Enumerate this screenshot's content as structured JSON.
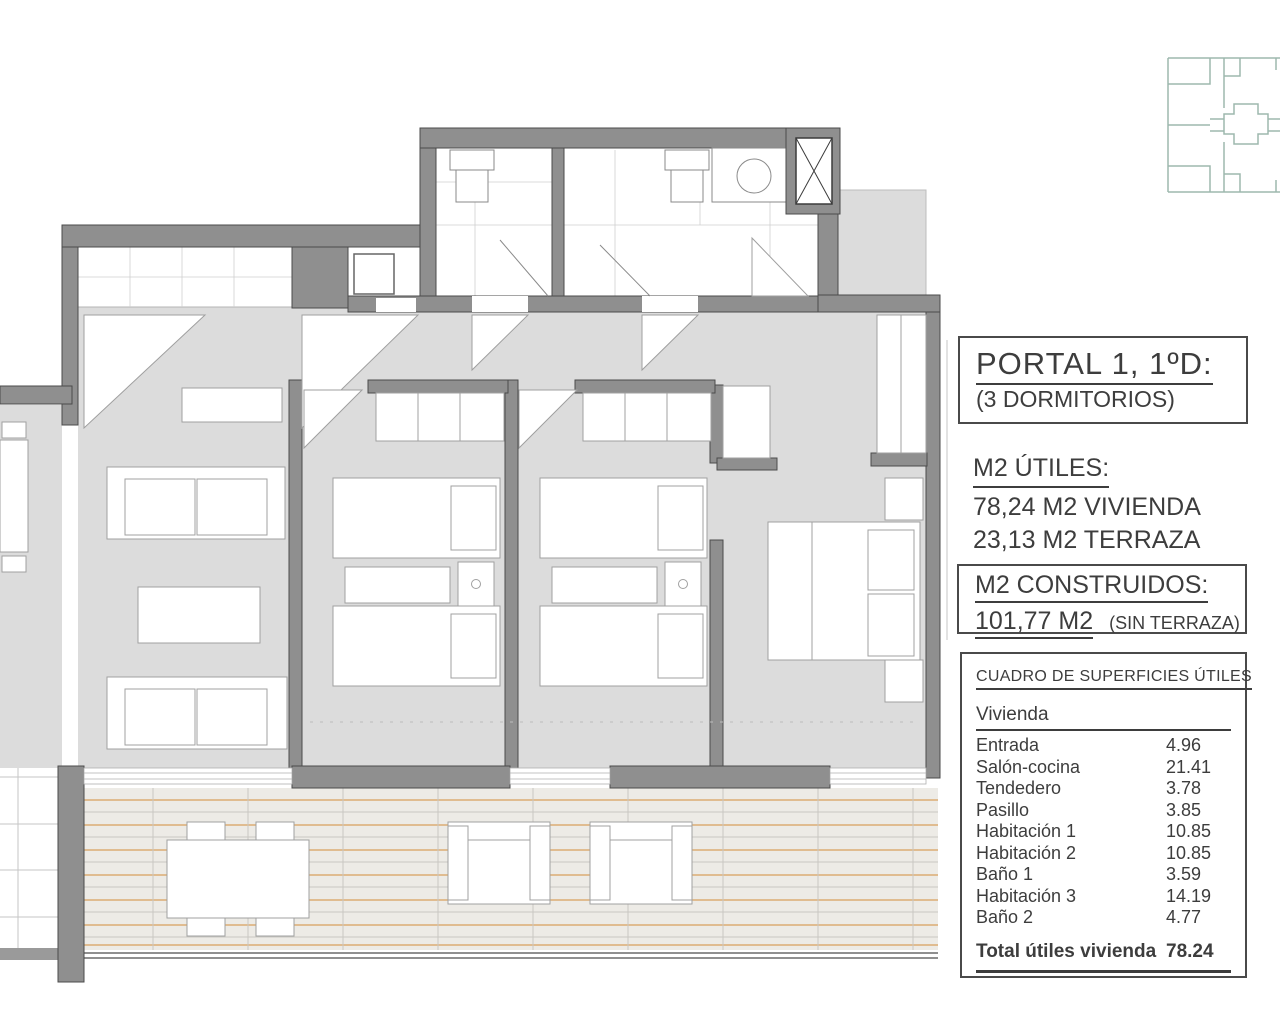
{
  "panel": {
    "title": "PORTAL 1, 1ºD:",
    "subtitle": "(3 DORMITORIOS)",
    "utiles": {
      "heading": "M2 ÚTILES:",
      "line1": "78,24 M2 VIVIENDA",
      "line2": "23,13 M2 TERRAZA"
    },
    "construidos": {
      "heading": "M2 CONSTRUIDOS:",
      "value": "101,77 M2",
      "note": "(SIN TERRAZA)"
    },
    "table": {
      "heading": "CUADRO DE SUPERFICIES ÚTILES",
      "group": "Vivienda",
      "rows": [
        {
          "label": "Entrada",
          "value": "4.96"
        },
        {
          "label": "Salón-cocina",
          "value": "21.41"
        },
        {
          "label": "Tendedero",
          "value": "3.78"
        },
        {
          "label": "Pasillo",
          "value": "3.85"
        },
        {
          "label": "Habitación 1",
          "value": "10.85"
        },
        {
          "label": "Habitación 2",
          "value": "10.85"
        },
        {
          "label": "Baño 1",
          "value": "3.59"
        },
        {
          "label": "Habitación 3",
          "value": "14.19"
        },
        {
          "label": "Baño 2",
          "value": "4.77"
        }
      ],
      "total_label": "Total útiles vivienda",
      "total_value": "78.24"
    }
  },
  "colors": {
    "wall_gray": "#8f8f8f",
    "wall_edge": "#4b4b4b",
    "floor_gray": "#dcdcdc",
    "terrace_floor": "#edebe6",
    "terrace_line_orange": "#d9a05e",
    "keyplan_teal": "#9db8ae",
    "text": "#3d3d3d"
  }
}
